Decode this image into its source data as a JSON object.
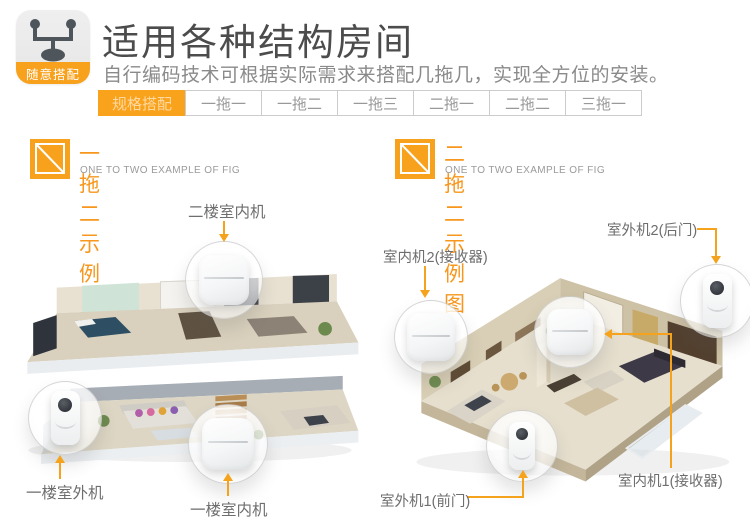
{
  "colors": {
    "accent": "#F7A11C",
    "tab_border": "#cccccc",
    "tab_text": "#999999",
    "active_tab_text": "#FFD9A0",
    "title_text": "#4c4c4c",
    "subtitle_text": "#8a8a8a",
    "label_text": "#6e6e6e"
  },
  "header": {
    "icon_name": "splitter-icon",
    "badge": "随意搭配",
    "title": "适用各种结构房间",
    "subtitle": "自行编码技术可根据实际需求来搭配几拖几，实现全方位的安装。"
  },
  "tabs": [
    {
      "label": "规格搭配",
      "active": true
    },
    {
      "label": "一拖一",
      "active": false
    },
    {
      "label": "一拖二",
      "active": false
    },
    {
      "label": "一拖三",
      "active": false
    },
    {
      "label": "二拖一",
      "active": false
    },
    {
      "label": "二拖二",
      "active": false
    },
    {
      "label": "三拖一",
      "active": false
    }
  ],
  "sections": [
    {
      "icon_name": "diagonal-square-icon",
      "title": "一拖二示例图",
      "subtitle_en": "ONE TO TWO EXAMPLE OF FIG",
      "labels": {
        "top": "二楼室内机",
        "bottom_left": "一楼室外机",
        "bottom_center": "一楼室内机"
      }
    },
    {
      "icon_name": "diagonal-square-icon",
      "title": "二拖二示例图",
      "subtitle_en": "ONE TO TWO EXAMPLE OF FIG",
      "labels": {
        "top_left": "室内机2(接收器)",
        "top_right": "室外机2(后门)",
        "bottom_left": "室外机1(前门)",
        "bottom_right": "室内机1(接收器)"
      }
    }
  ]
}
